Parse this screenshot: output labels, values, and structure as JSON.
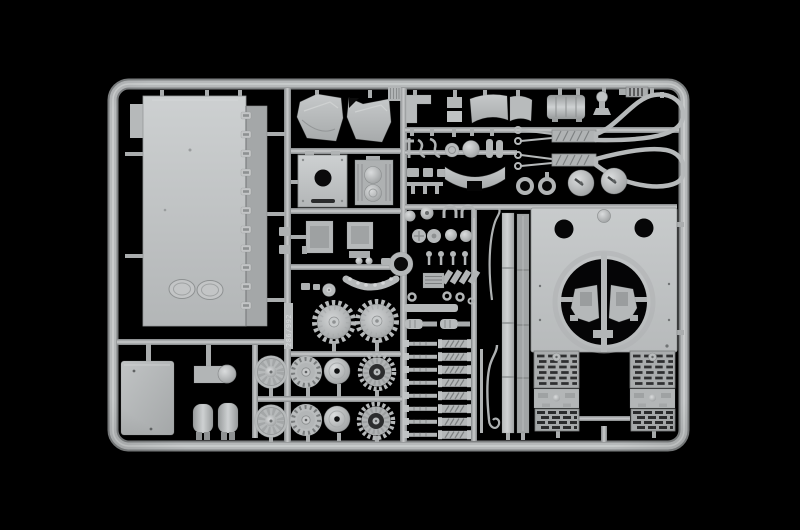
{
  "scene": {
    "type": "studio product photograph",
    "subject": "injection-molded polystyrene sprue (parts tree) of a military tank model kit",
    "background_color": "#000000",
    "plastic_color": "#b9bcbd",
    "plastic_highlight": "#d6d8d9",
    "plastic_shadow": "#8a8d8e",
    "mold_number": "286/992"
  },
  "sprue": {
    "frame_shape": "rounded rectangle",
    "parts_inventory": [
      "sprue frame with runners",
      "hull roof panel with two oval hatches and hook tabs",
      "stowage box",
      "auxiliary box with domed pump",
      "exhaust mufflers",
      "spoked road wheels",
      "slotted road wheels",
      "idler hub cones",
      "sprocket rings",
      "drive sprockets",
      "studded fender arc",
      "turret ring part",
      "hull bins",
      "periscope plate with round opening",
      "engine block with twin cylinders",
      "turret side panels",
      "L-bracket",
      "fender arc sections",
      "air filter box",
      "funnel",
      "slatted vent grille",
      "tow cables with teardrop loop ends",
      "hatch discs and rings",
      "tool and clamp fittings",
      "towing shackles",
      "valve pins and periscopes",
      "gun mantlet arc",
      "shock absorbers",
      "torsion bar springs",
      "hull side strips",
      "hull plate with turret ring opening",
      "louvered engine deck grilles",
      "mesh engine deck grilles"
    ]
  }
}
